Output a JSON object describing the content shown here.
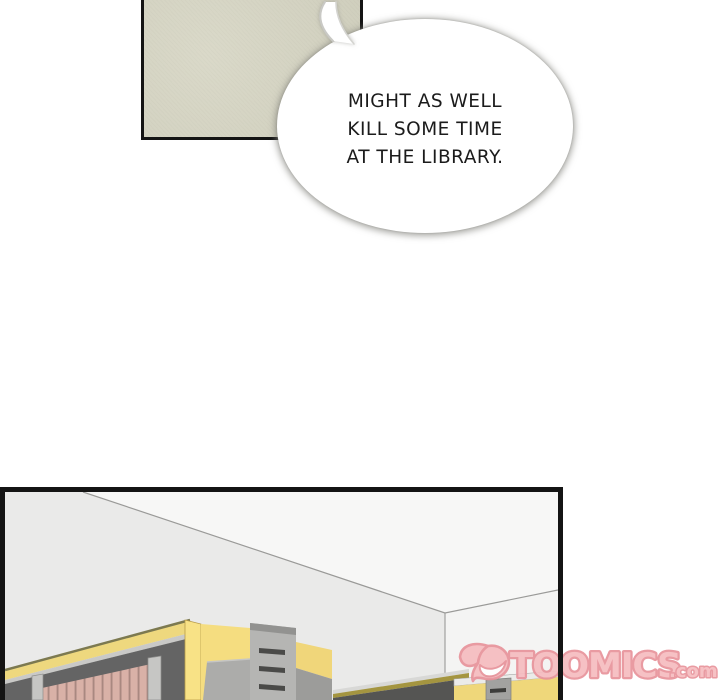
{
  "page": {
    "background": "#ffffff"
  },
  "panels": {
    "top": {
      "fill": "#d6d5c3",
      "border": "#141414"
    },
    "bottom": {
      "border": "#141414"
    }
  },
  "speech_bubble": {
    "lines": [
      "MIGHT AS WELL",
      "KILL SOME TIME",
      "AT THE LIBRARY."
    ],
    "fill": "#ffffff",
    "text_color": "#1b1b1b"
  },
  "watermark": {
    "brand": "TOOMICS",
    "suffix": ".com",
    "fill": "#f6bcc0",
    "outline": "#e8939b",
    "smile_fill": "#ffffff"
  },
  "scene": {
    "colors": {
      "ceiling": "#f7f7f6",
      "left_wall": "#eaeae9",
      "right_wall": "#f4f4f3",
      "wall_line": "#9a9a98",
      "fascia_yellow": "#eed87e",
      "ridge_yellow": "#f8e286",
      "end_panel_yellow": "#f5dd80",
      "band_yellow": "#f0d67a",
      "unit_yellow": "#efd77a",
      "olive_edge": "#7c7950",
      "olive_low": "#a49540",
      "under_dark": "#646464",
      "low_dark": "#555553",
      "books_pink": "#d9b1a7",
      "books_gap": "#a98880",
      "shelf_strip": "#c9c9c7",
      "low_strip": "#d8d8d6",
      "column_gray": "#b5b5b3",
      "column_top": "#929290",
      "slab_gray": "#acacaa",
      "slab_edge": "#c6c6c4",
      "slot_dark": "#4a4a48",
      "cabinet_gray": "#a2a2a0",
      "cabinet_slot": "#3d3d3b",
      "post_gray": "#c6c6c4",
      "lower_gray": "#9c9c9a",
      "unit_band": "#ebebe9"
    }
  }
}
